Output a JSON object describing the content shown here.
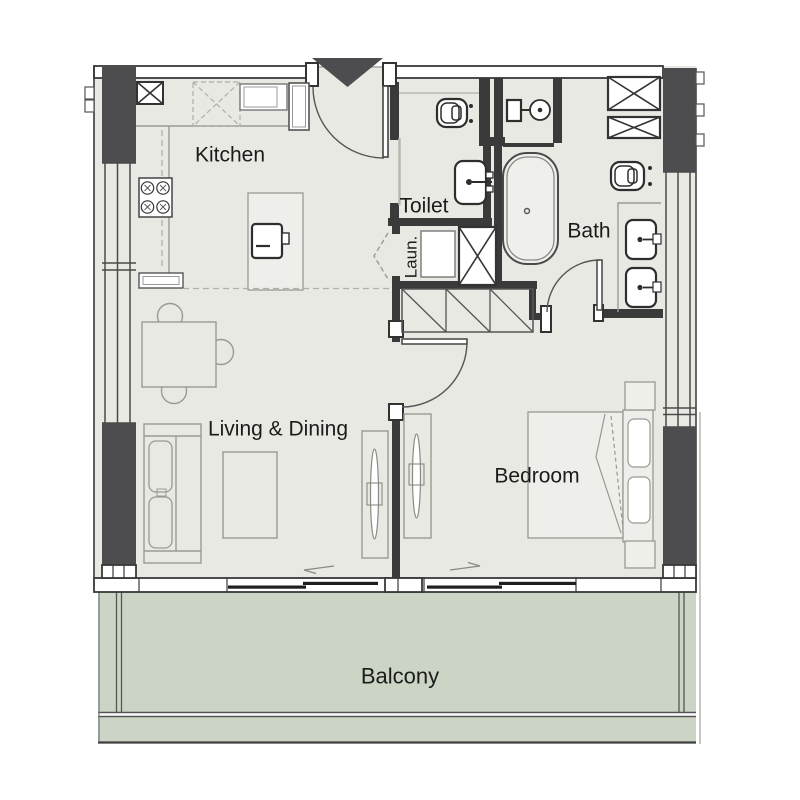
{
  "plan": {
    "rooms": {
      "kitchen": {
        "label": "Kitchen"
      },
      "toilet": {
        "label": "Toilet"
      },
      "laundry": {
        "label": "Laun."
      },
      "bath": {
        "label": "Bath"
      },
      "living_dining": {
        "label": "Living & Dining"
      },
      "bedroom": {
        "label": "Bedroom"
      },
      "balcony": {
        "label": "Balcony"
      }
    },
    "colors": {
      "floor": "#e9e9e4",
      "balcony_floor": "#ccd5c5",
      "column_fill": "#4d4d4f",
      "entry_marker": "#4d4d4f",
      "wall_line": "#383838",
      "text": "#1b1b1b",
      "background": "#ffffff"
    }
  }
}
